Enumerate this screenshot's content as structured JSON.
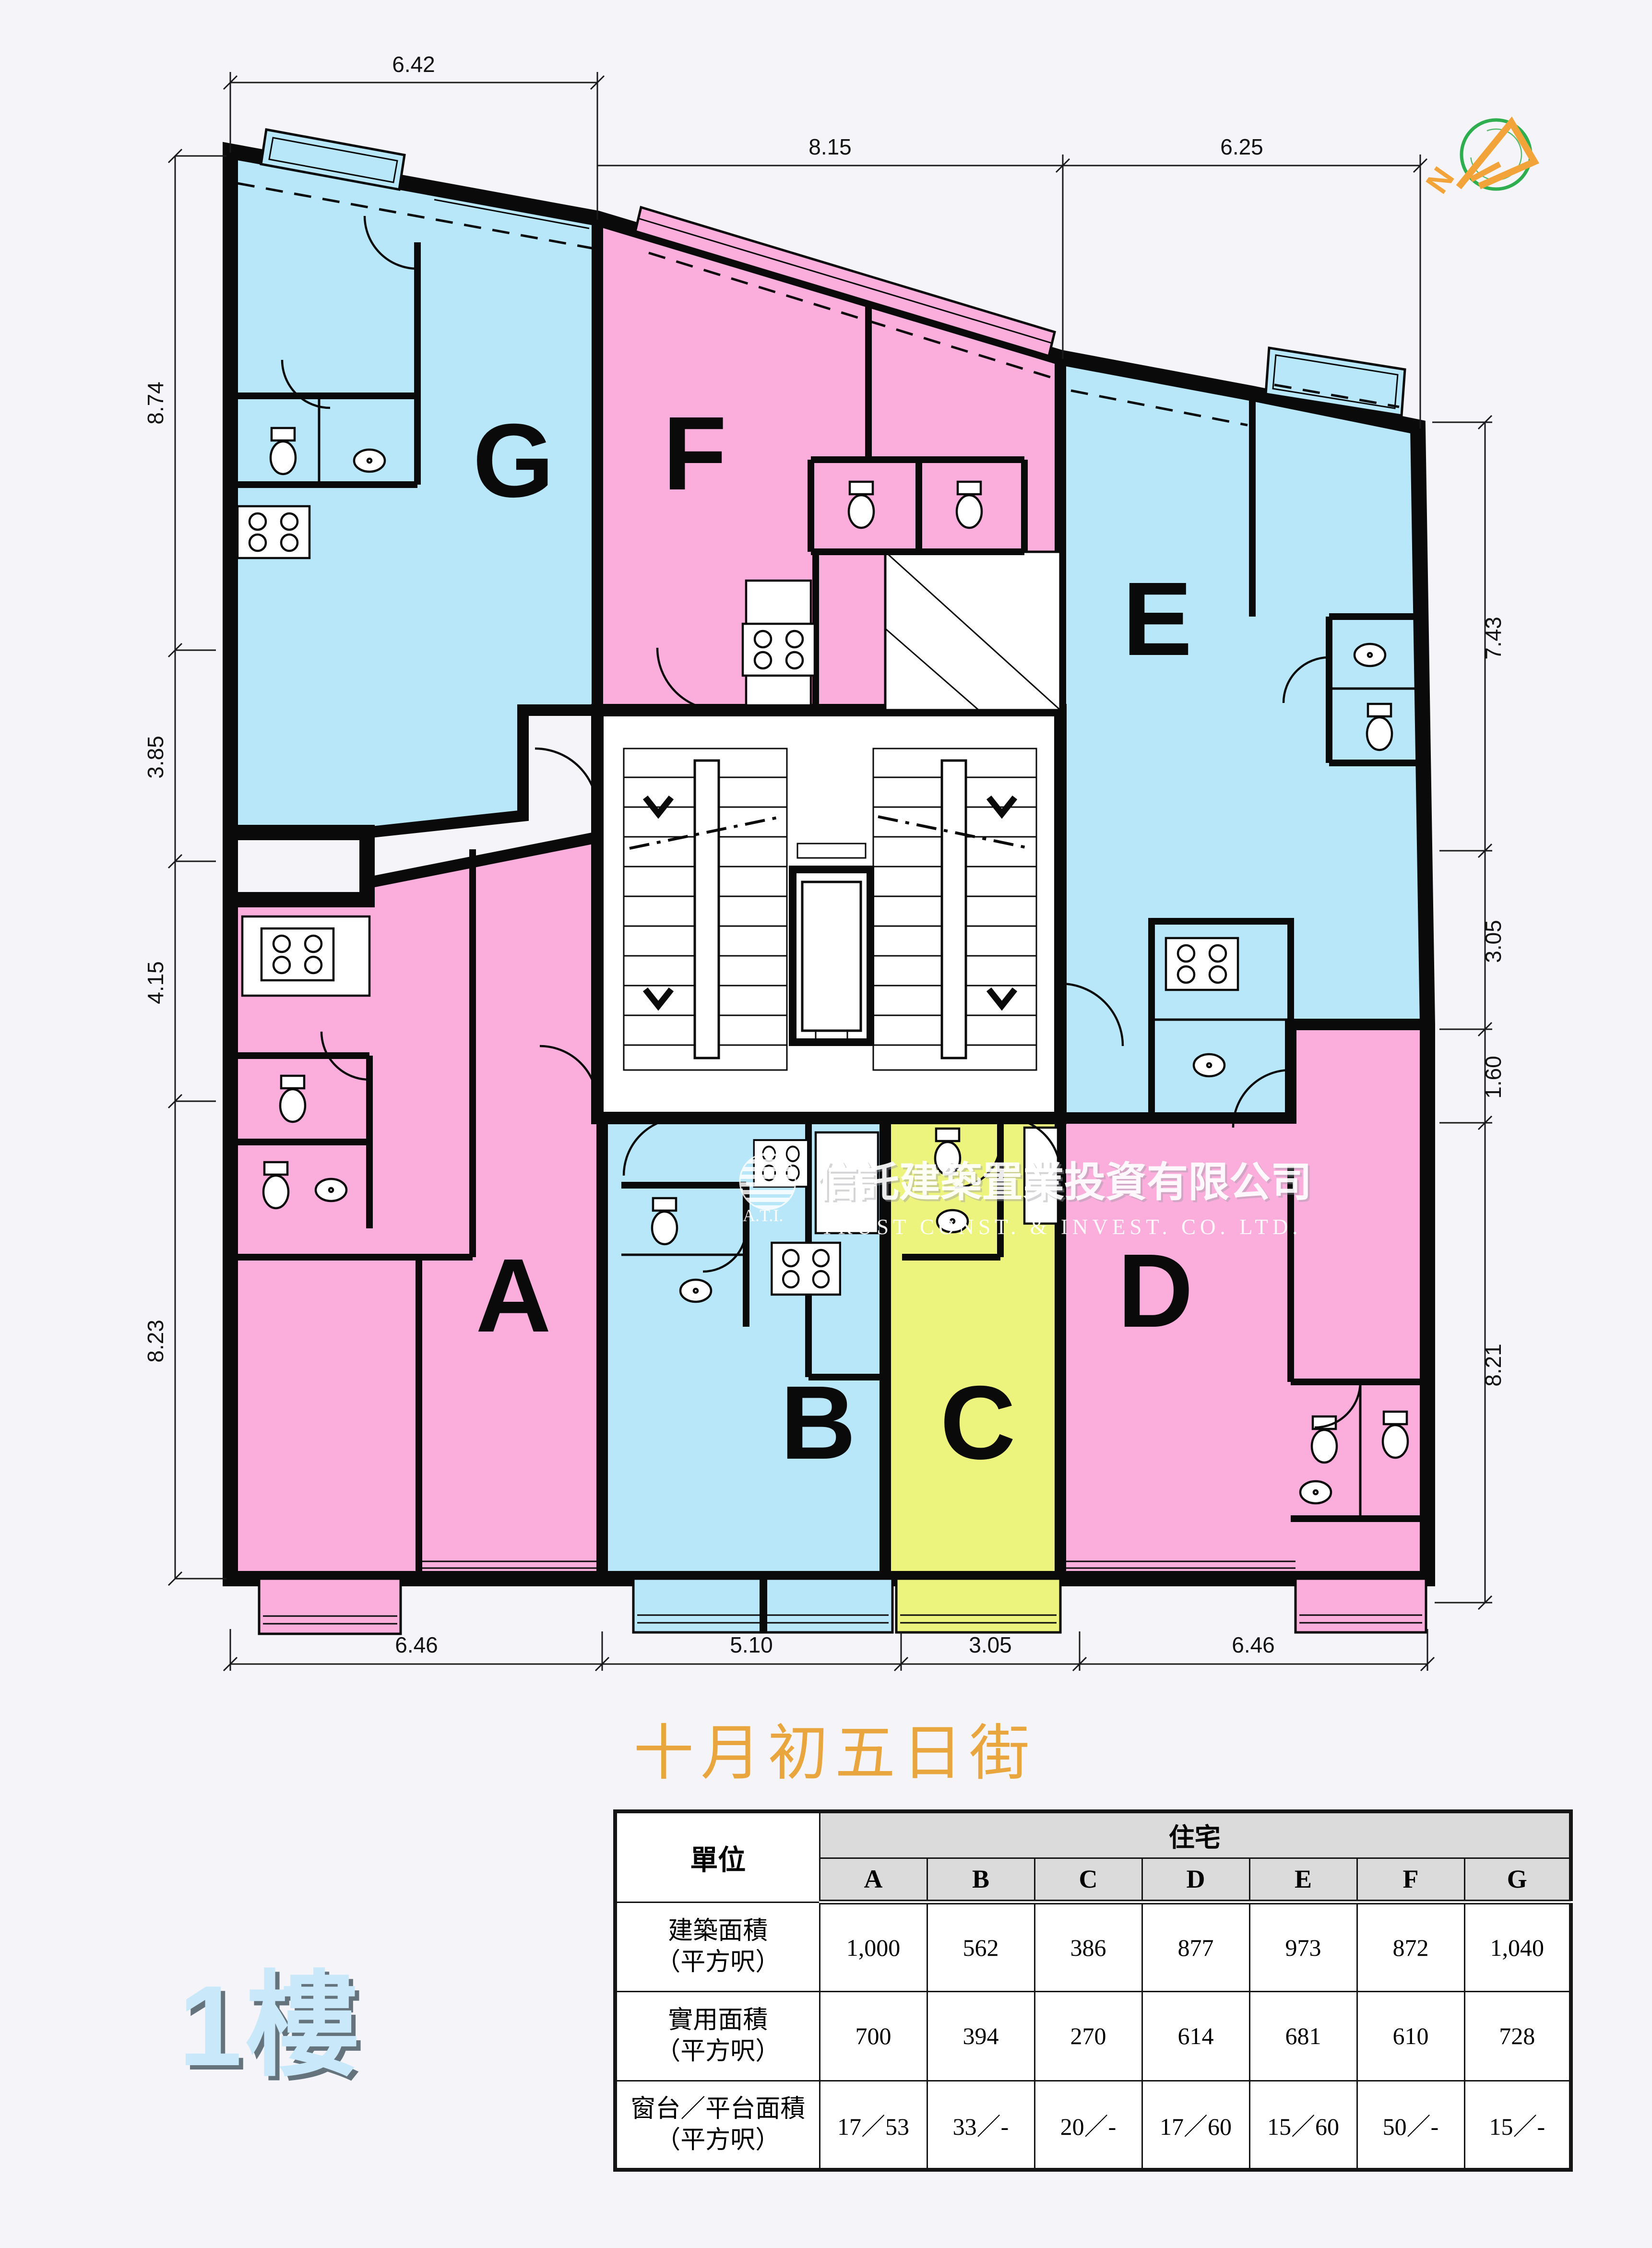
{
  "street_name": "十月初五日街",
  "floor_label": "1樓",
  "compass": {
    "letter": "N"
  },
  "watermark": {
    "logo_text": "A.T.I.",
    "line_cn": "信託建築置業投資有限公司",
    "line_en": "TRUST CONST. & INVEST. CO. LTD."
  },
  "units": {
    "A": {
      "label": "A"
    },
    "B": {
      "label": "B"
    },
    "C": {
      "label": "C"
    },
    "D": {
      "label": "D"
    },
    "E": {
      "label": "E"
    },
    "F": {
      "label": "F"
    },
    "G": {
      "label": "G"
    }
  },
  "dimensions": {
    "top_left": "6.42",
    "top": [
      "8.15",
      "6.25"
    ],
    "left": [
      "8.74",
      "3.85",
      "4.15",
      "8.23"
    ],
    "right": [
      "7.43",
      "3.05",
      "1.60",
      "8.21"
    ],
    "bottom": [
      "6.46",
      "5.10",
      "3.05",
      "6.46"
    ]
  },
  "colors": {
    "pink": "#FBAEDC",
    "blue": "#B9E7FA",
    "yellow": "#EDF47E",
    "wall": "#0A0A0A",
    "background": "#F4F4F9",
    "street_text": "#E9A63F",
    "floor_label_text": "#C9E9FB",
    "compass_green": "#2FAE4F",
    "compass_orange": "#F2A33A",
    "table_header_bg": "#DBDBDB"
  },
  "table": {
    "unit_col_header": "單位",
    "group_header": "住宅",
    "columns": [
      "A",
      "B",
      "C",
      "D",
      "E",
      "F",
      "G"
    ],
    "rows": [
      {
        "label": "建築面積",
        "sublabel": "（平方呎）",
        "values": [
          "1,000",
          "562",
          "386",
          "877",
          "973",
          "872",
          "1,040"
        ]
      },
      {
        "label": "實用面積",
        "sublabel": "（平方呎）",
        "values": [
          "700",
          "394",
          "270",
          "614",
          "681",
          "610",
          "728"
        ]
      },
      {
        "label": "窗台／平台面積",
        "sublabel": "（平方呎）",
        "values": [
          "17／53",
          "33／-",
          "20／-",
          "17／60",
          "15／60",
          "50／-",
          "15／-"
        ]
      }
    ]
  }
}
